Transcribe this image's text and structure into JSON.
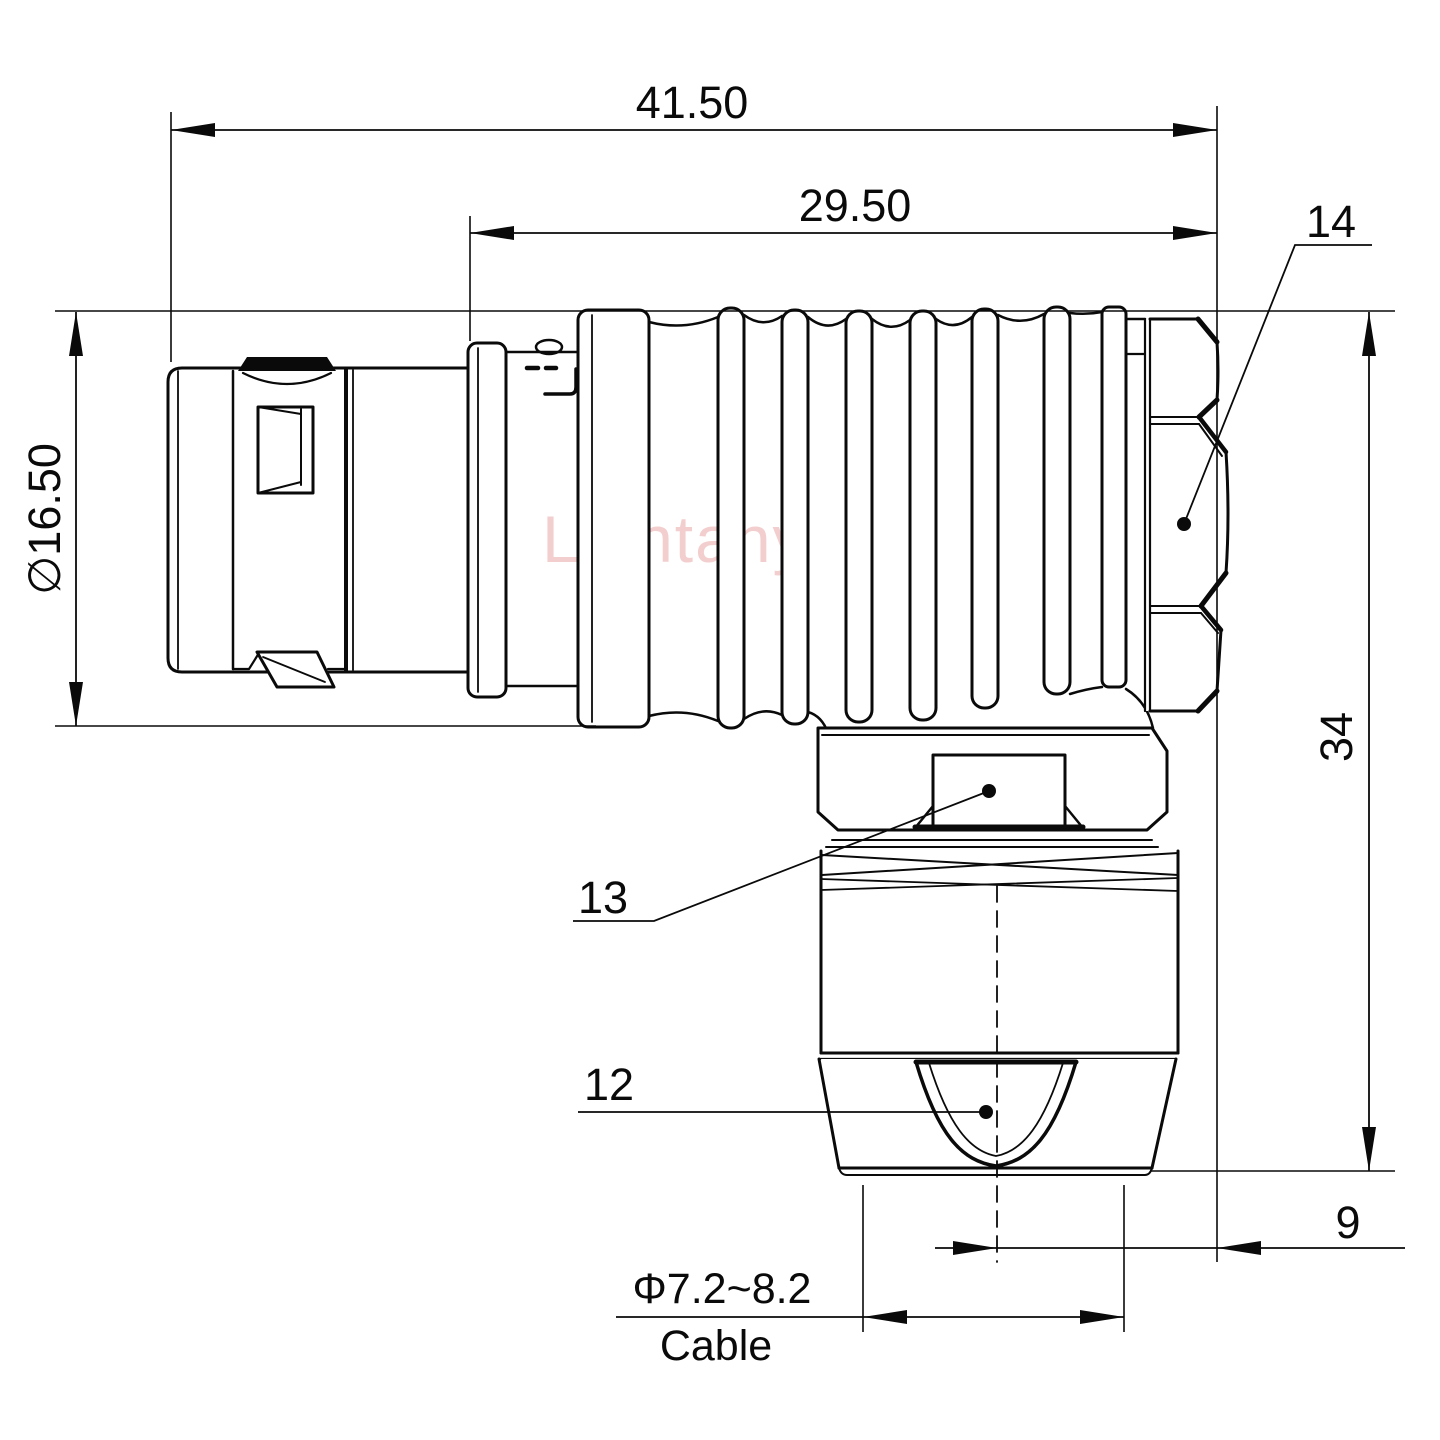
{
  "drawing": {
    "watermark": "Lightany",
    "dims": {
      "overall_length": "41.50",
      "rear_section_length": "29.50",
      "shell_diameter": "∅16.50",
      "elbow_height": "34",
      "axis_to_face": "9",
      "cable_range": "Φ7.2~8.2",
      "cable_word": "Cable"
    },
    "labels": {
      "coupling_nut": "14",
      "wrench_flats": "13",
      "cable_gland": "12"
    },
    "colors": {
      "line": "#0a0a0a",
      "background": "#ffffff",
      "watermark": "#eba7a7"
    }
  }
}
